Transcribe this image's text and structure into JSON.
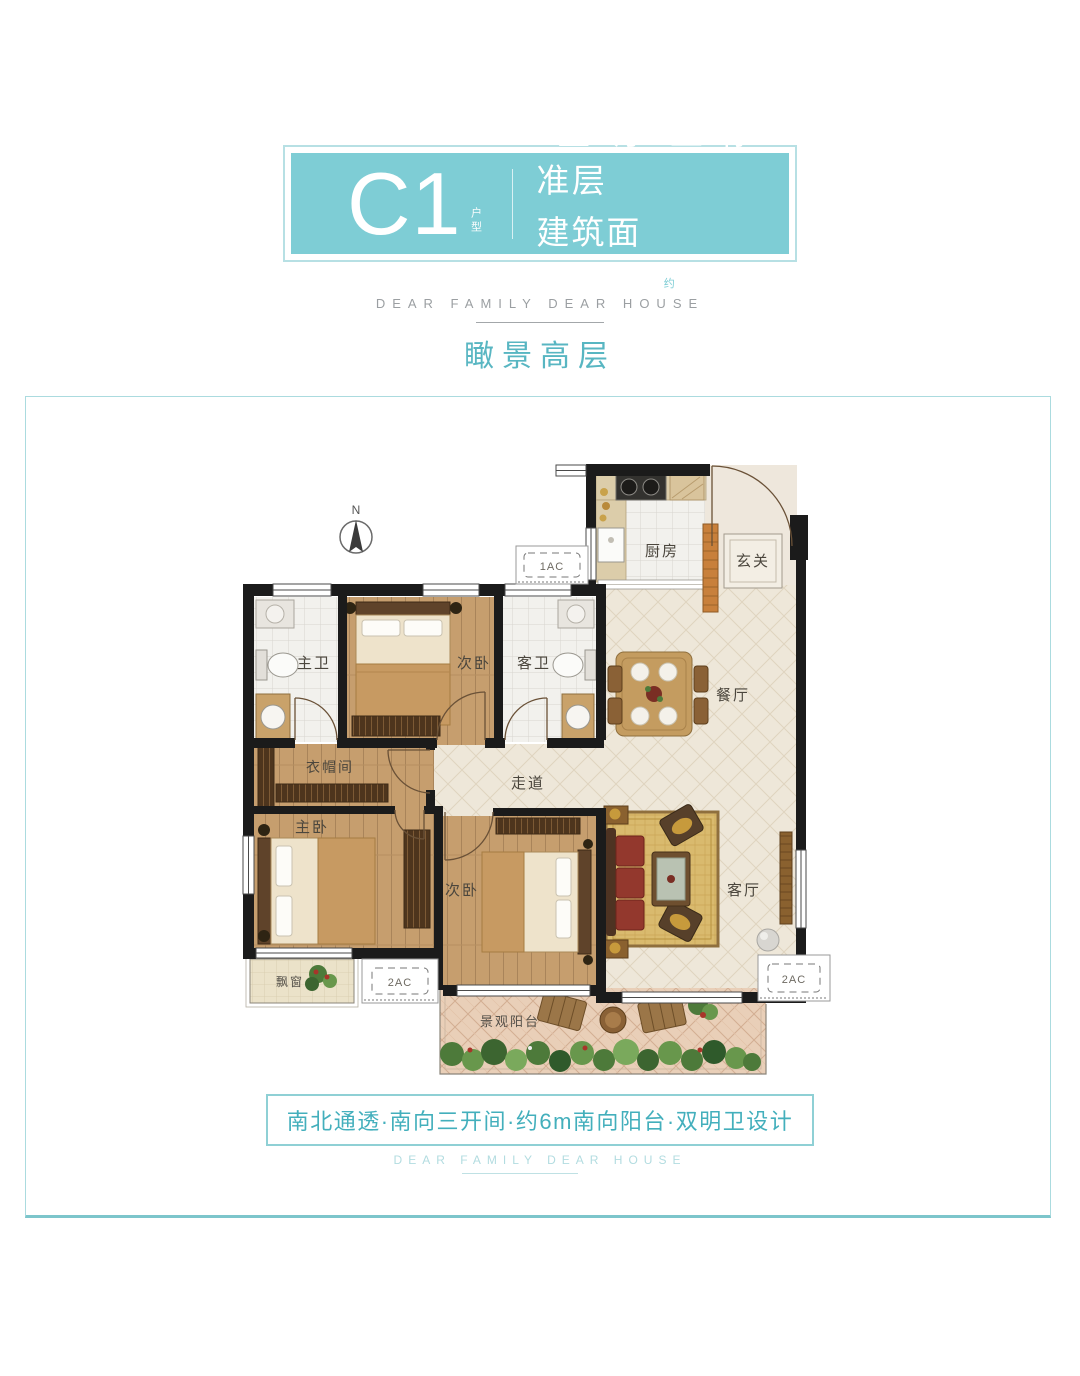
{
  "header": {
    "unit_code": "C1",
    "unit_code_suffix": "户型",
    "spec_line1": "3室2厅2卫·标准层",
    "spec_area_label": "建筑面积",
    "spec_area_approx": "约",
    "spec_area_value": "99m",
    "spec_area_sup": "2",
    "tagline_en": "DEAR FAMILY DEAR HOUSE",
    "headline": "瞰景高层"
  },
  "floorplan": {
    "compass": "N",
    "rooms": {
      "kitchen": "厨房",
      "entry": "玄关",
      "master_bath": "主卫",
      "bedroom2_top": "次卧",
      "guest_bath": "客卫",
      "dining": "餐厅",
      "cloakroom": "衣帽间",
      "corridor": "走道",
      "master_bedroom": "主卧",
      "bedroom2_bottom": "次卧",
      "living": "客厅",
      "bay_window": "飘窗",
      "balcony": "景观阳台"
    },
    "ac": {
      "top": "1AC",
      "bottom_left": "2AC",
      "bottom_right": "2AC"
    }
  },
  "footer": {
    "highlights": "南北通透·南向三开间·约6m南向阳台·双明卫设计",
    "tagline_en": "DEAR FAMILY DEAR HOUSE"
  },
  "colors": {
    "badge_teal": "#7ecdd5",
    "headline_teal": "#58b6c2",
    "footer_teal": "#43afbc",
    "tagline_gray": "#9b9fa2",
    "box_border_teal": "#abdbdf",
    "wall_black": "#1b1b1b",
    "wood_floor": "#c69e6e"
  }
}
